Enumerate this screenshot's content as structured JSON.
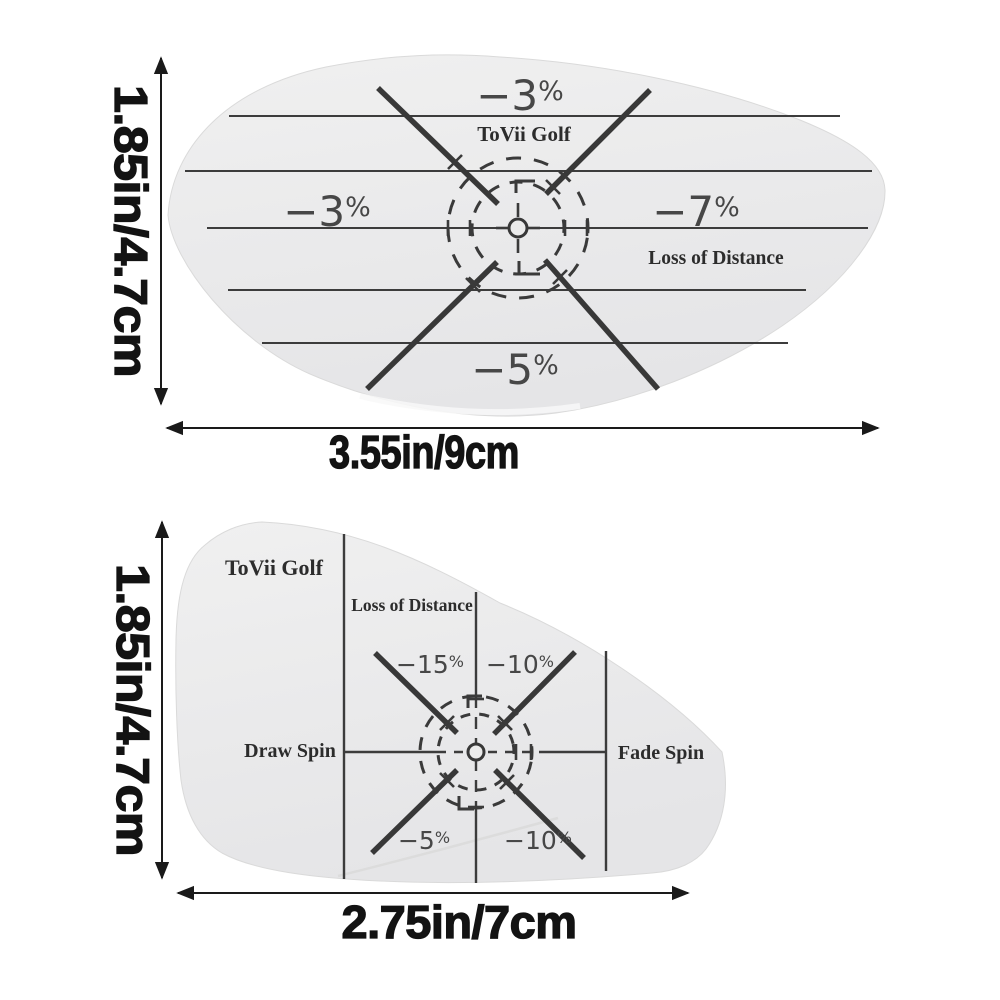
{
  "colors": {
    "sticker_fill_light": "#f0f0f0",
    "sticker_fill_dark": "#e5e5e7",
    "ink": "#3a3a3a",
    "pct_ink": "#474747",
    "dimension_ink": "#131313"
  },
  "top_sticker": {
    "brand": "ToVii Golf",
    "distance_note": "Loss of Distance",
    "zones": {
      "top": {
        "num": "−3",
        "pct": "%"
      },
      "left": {
        "num": "−3",
        "pct": "%"
      },
      "right": {
        "num": "−7",
        "pct": "%"
      },
      "bottom": {
        "num": "−5",
        "pct": "%"
      }
    },
    "height_label": "1.85in/4.7cm",
    "width_label": "3.55in/9cm"
  },
  "bottom_sticker": {
    "brand": "ToVii Golf",
    "distance_note": "Loss of Distance",
    "draw_label": "Draw Spin",
    "fade_label": "Fade Spin",
    "zones": {
      "upper_left": {
        "num": "−15",
        "pct": "%"
      },
      "upper_right": {
        "num": "−10",
        "pct": "%"
      },
      "lower_left": {
        "num": "−5",
        "pct": "%"
      },
      "lower_right": {
        "num": "−10",
        "pct": "%"
      }
    },
    "height_label": "1.85in/4.7cm",
    "width_label": "2.75in/7cm"
  }
}
